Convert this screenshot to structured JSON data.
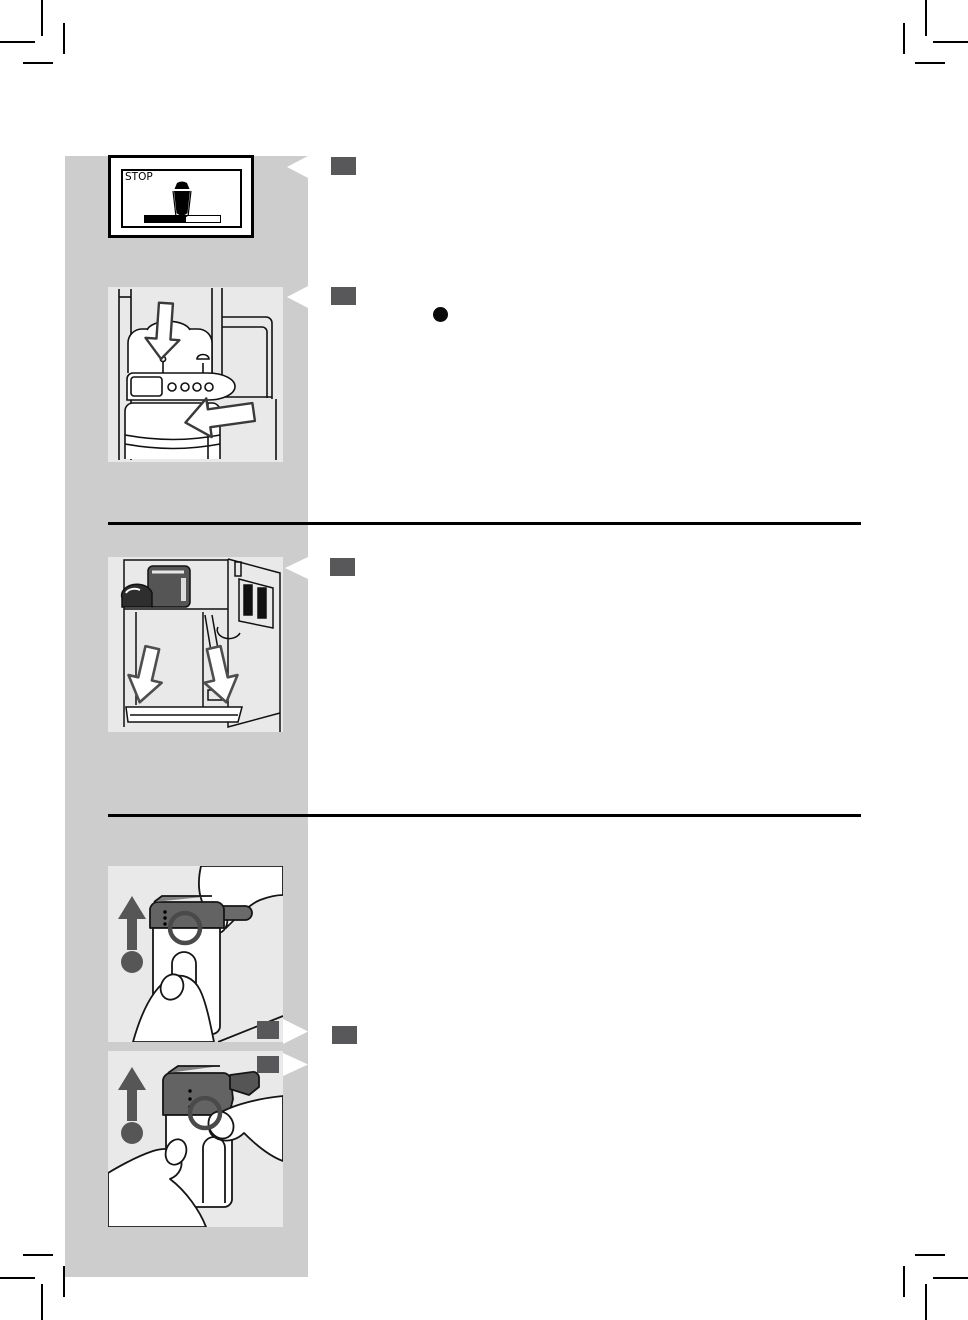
{
  "page": {
    "kind": "instruction-manual-page",
    "width": 968,
    "height": 1320
  },
  "colors": {
    "page_bg": "#ffffff",
    "band": "#cdcdcd",
    "figure_bg": "#e9e9e9",
    "marker": "#58585a",
    "ink": "#111111",
    "part_dark": "#636363",
    "part_darker": "#4a4a4a",
    "symbol_gray": "#565656"
  },
  "display_screen": {
    "status_text": "STOP",
    "progress_fill_style": "width:55%"
  },
  "markers": {
    "step_marker_count": 4,
    "sub_marker_count": 2,
    "bullet_icon": "filled-circle"
  },
  "figures": [
    {
      "id": "figure-1",
      "icon": "stop-screen",
      "elements": [
        "stop-label",
        "milk-carafe-icon",
        "progress-bar"
      ]
    },
    {
      "id": "figure-2",
      "icon": "machine-top-insert-carafe",
      "elements": [
        "down-arrow-icon",
        "left-arrow-icon",
        "control-panel-buttons"
      ]
    },
    {
      "id": "figure-3",
      "icon": "machine-open-door",
      "elements": [
        "down-arrow-icon",
        "down-arrow-icon",
        "drip-tray"
      ]
    },
    {
      "id": "figure-4",
      "icon": "milk-carafe-lift-hand",
      "elements": [
        "up-arrow-icon",
        "grip-ring",
        "hand"
      ]
    },
    {
      "id": "figure-5",
      "icon": "milk-carafe-press-button",
      "elements": [
        "up-arrow-icon",
        "button-ring",
        "hands"
      ]
    }
  ]
}
